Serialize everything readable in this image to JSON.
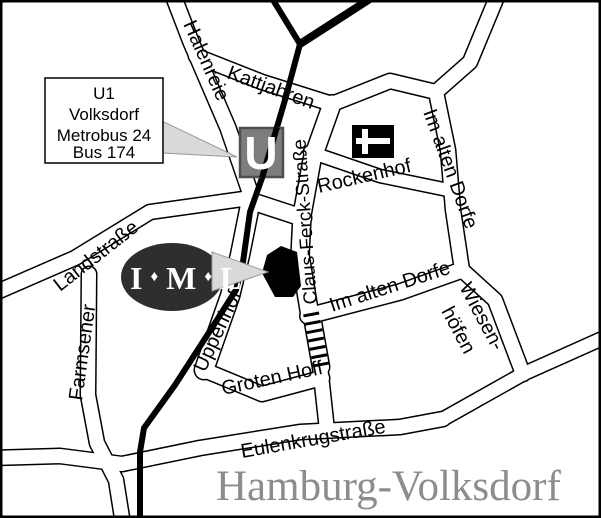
{
  "map": {
    "region_title": "Hamburg-Volksdorf",
    "station_sign": {
      "line1": "U1",
      "line2": "Volksdorf",
      "line3": "Metrobus 24",
      "line4": "Bus 174"
    },
    "ubahn_symbol": "U",
    "iml_logo": {
      "i": "I",
      "d1": "♦",
      "m": "M",
      "d2": "♦",
      "l": "L"
    },
    "streets": {
      "halenreie": "Halenreie",
      "kattjahren": "Kattjahren",
      "landstrasse": "Landstraße",
      "farmsener": "Farmsener",
      "claus_ferck_strasse": "Claus-Ferck-Straße",
      "rockenhof": "Rockenhof",
      "im_alten_dorfe_north": "Im alten Dorfe",
      "im_alten_dorfe_south": "Im alten Dorfe",
      "wiesenhoefen_line1": "Wiesen-",
      "wiesenhoefen_line2": "höfen",
      "uppenhof": "Uppenhof",
      "groten_hoff": "Groten Hoff",
      "eulenkrugstrasse": "Eulenkrugstraße"
    },
    "icons": {
      "ubahn_station": "u-bahn-station-icon",
      "church": "church-flag-icon"
    },
    "colors": {
      "railway": "#000000",
      "street_fill": "#ffffff",
      "street_casing": "#000000",
      "ubahn_box_fill": "#7d7d7d",
      "ubahn_box_border": "#4f4f4f",
      "pointer_fill": "#d9d9d9",
      "pointer_border": "#9a9a9a",
      "iml_ellipse": "#2e2e2e",
      "building": "#000000",
      "title_gray": "#8c8c8c"
    }
  }
}
